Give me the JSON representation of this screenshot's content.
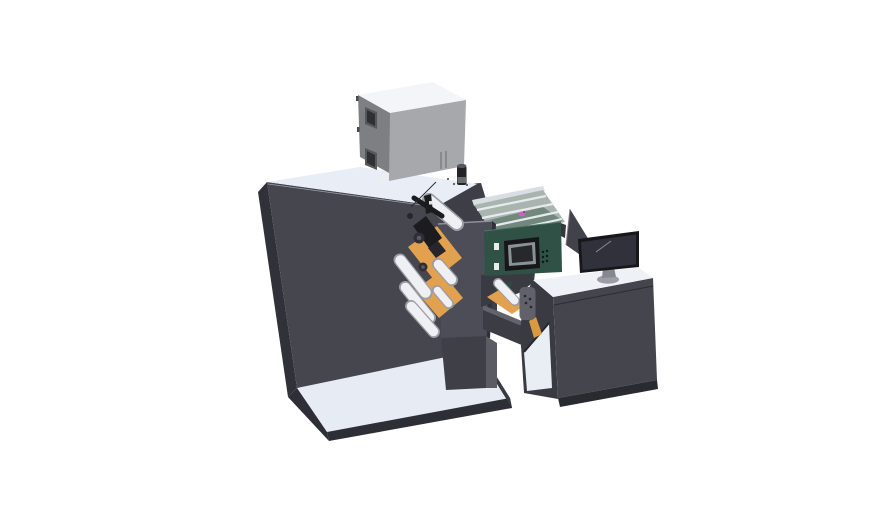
{
  "scene": {
    "description": "3D CAD isometric render of a roll-fed label printing machine with electrical cabinet, web rollers, HMI control panel, output tray module and operator desk with monitor, on a white background",
    "background": "#ffffff"
  },
  "legend": {
    "base_platform": "floor base platform",
    "main_cabinet": "printing machine main cabinet",
    "electrical_box": "electrical control box on top",
    "tower_cylinder": "cylindrical filter column",
    "output_tray": "open tray module with guide rails",
    "print_head": "print head assembly",
    "rollers": "web guide rollers",
    "web_plates": "orange web guide plates",
    "front_panel": "front door panel",
    "hmi_panel": "control panel with display and buttons",
    "side_screen": "side deflector screen",
    "operator_desk": "operator desk with open bay",
    "monitor": "desktop monitor on stand"
  },
  "colors": {
    "background": "#ffffff",
    "base_top": "#e7ebf3",
    "base_edge": "#2e2e36",
    "base_end": "#3a3a43",
    "cab_front": "#46464f",
    "cab_front_dark": "#3e3e46",
    "cab_left": "#31313a",
    "cab_top": "#e9edf5",
    "cab_top_edge": "#9aa0ac",
    "screw": "#5b5b64",
    "box_top": "#f3f5f8",
    "box_front": "#a6a8ab",
    "box_left": "#7d7f83",
    "box_win": "#56585c",
    "box_win_in": "#2e3034",
    "box_slot": "#74767a",
    "box_chip": "#eceef0",
    "box_hinge": "#46484c",
    "cyl_body": "#232327",
    "cyl_top": "#6a6c70",
    "cyl_band": "#55565c",
    "tray_wall": "#d9dee4",
    "tray_bed": "#a9b4ae",
    "tray_tint": "#73887d",
    "tray_rail": "#e6eaee",
    "tray_rim": "#cfd4d8",
    "tray_end": "#34363a",
    "carriage_pink": "#cf5fc5",
    "carriage_pink_dark": "#8c2f9c",
    "panel": "#4d4d57",
    "panel_edge": "#90909a",
    "panel_side": "#30303a",
    "orange": "#e2a14e",
    "orange_dark": "#b97f2e",
    "orange_deep": "#d99a42",
    "head_black": "#1b1b20",
    "head_black2": "#26262c",
    "knob": "#2e2e35",
    "knob_rim": "#101014",
    "knob_core": "#5a5a64",
    "chip_white": "#dfe2e6",
    "wire": "#2a2a30",
    "roller_edge": "#9c9ca4",
    "roller": "#eff0f4",
    "block": "#3f3f48",
    "block_side": "#5b5b64",
    "bridge": "#3c3c45",
    "bridge_top": "#63636c",
    "frame": "#3a3a42",
    "pcb_green": "#2f4a3c",
    "hmi": "#2f5146",
    "hmi_edge": "#1d362c",
    "hmi_hl": "#4f7767",
    "bezel": "#17171a",
    "screen_frame": "#8a9296",
    "screen_center": "#26282c",
    "button_dot": "#15151a",
    "mount_white": "#e9ebed",
    "mount_edge": "#4a4a50",
    "divider": "#42424b",
    "divider_edge": "#7d7d87",
    "desk_side": "#3a3a43",
    "bay_white": "#e9edf4",
    "bay_edge": "#25252b",
    "desk_front": "#45454e",
    "desk_crease": "#2b2b32",
    "desk_plinth": "#2a2a31",
    "desk_top": "#eef1f6",
    "desk_top_edge": "#a7adb6",
    "bracket": "#61616b",
    "bracket_edge": "#393941",
    "bracket_dot": "#26262c",
    "mon_screen": "#30313a",
    "mon_hl": "#8b8b95",
    "mon_neck": "#86888f",
    "mon_base": "#9c9ea5",
    "mon_base_edge": "#606268"
  }
}
